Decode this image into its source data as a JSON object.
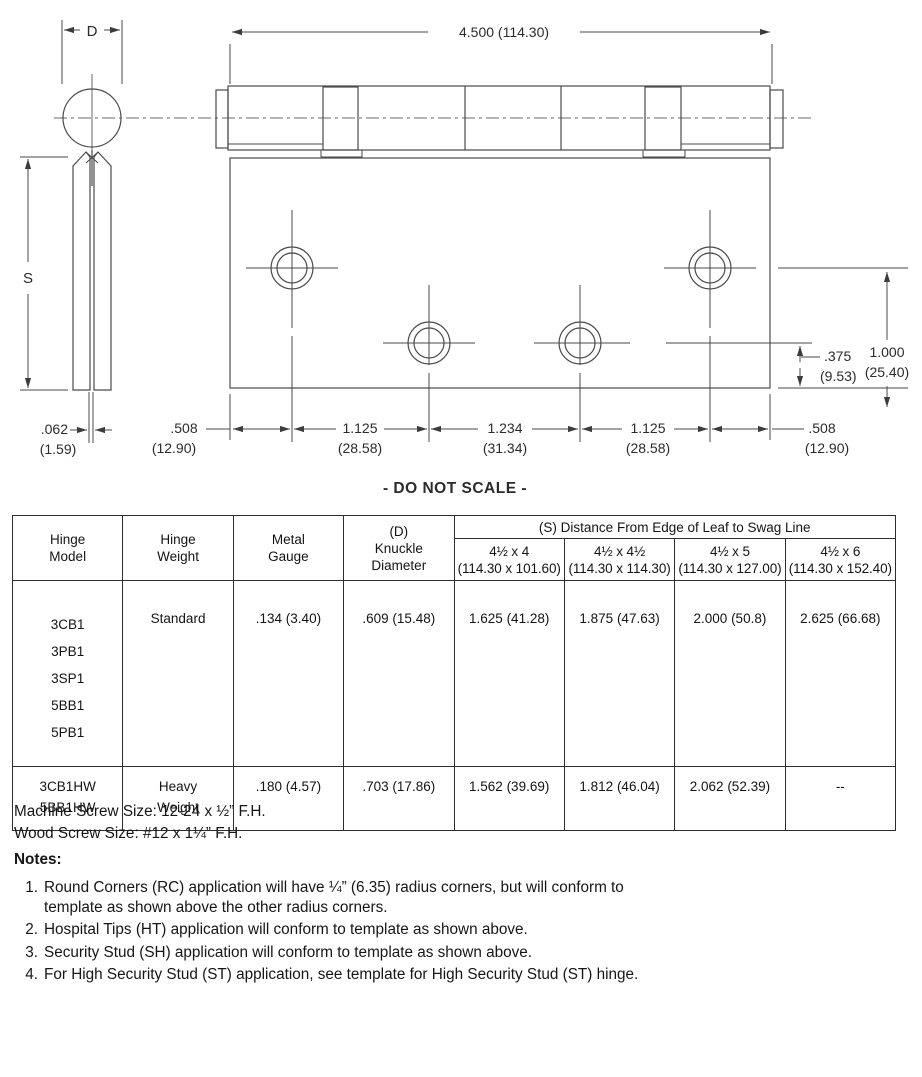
{
  "drawing": {
    "side": {
      "d": "D",
      "s": "S",
      "gap_in": ".062",
      "gap_mm": "(1.59)"
    },
    "front": {
      "overall": "4.500 (114.30)",
      "edge_left_in": ".508",
      "edge_left_mm": "(12.90)",
      "pitch1_in": "1.125",
      "pitch1_mm": "(28.58)",
      "pitch2_in": "1.234",
      "pitch2_mm": "(31.34)",
      "pitch3_in": "1.125",
      "pitch3_mm": "(28.58)",
      "edge_right_in": ".508",
      "edge_right_mm": "(12.90)",
      "hole_edge_in": ".375",
      "hole_edge_mm": "(9.53)",
      "row_edge_in": "1.000",
      "row_edge_mm": "(25.40)"
    },
    "do_not_scale": "- DO NOT SCALE -"
  },
  "table": {
    "headers": {
      "model": "Hinge\nModel",
      "weight": "Hinge\nWeight",
      "gauge": "Metal\nGauge",
      "knuckle": "(D)\nKnuckle\nDiameter",
      "s_group": "(S) Distance From Edge of Leaf to Swag Line",
      "sizes": [
        "4½ x 4\n(114.30 x 101.60)",
        "4½ x 4½\n(114.30 x 114.30)",
        "4½ x 5\n(114.30 x 127.00)",
        "4½ x 6\n(114.30 x 152.40)"
      ]
    },
    "rows": [
      {
        "models": "3CB1\n3PB1\n3SP1\n5BB1\n5PB1",
        "weight": "Standard",
        "gauge": ".134 (3.40)",
        "knuckle": ".609 (15.48)",
        "s1": "1.625 (41.28)",
        "s2": "1.875 (47.63)",
        "s3": "2.000 (50.8)",
        "s4": "2.625 (66.68)"
      },
      {
        "models": "3CB1HW\n5BB1HW",
        "weight": "Heavy\nWeight",
        "gauge": ".180 (4.57)",
        "knuckle": ".703 (17.86)",
        "s1": "1.562 (39.69)",
        "s2": "1.812 (46.04)",
        "s3": "2.062 (52.39)",
        "s4": "--"
      }
    ]
  },
  "screws": {
    "machine": "Machine Screw Size: 12-24 x ½” F.H.",
    "wood": "Wood Screw Size: #12 x 1¼” F.H."
  },
  "notes": {
    "title": "Notes:",
    "items": [
      {
        "num": "1.",
        "text": "Round Corners (RC) application will have ¼” (6.35) radius corners, but will conform to\ntemplate as shown above the other radius corners."
      },
      {
        "num": "2.",
        "text": "Hospital Tips (HT) application will conform to template as shown above."
      },
      {
        "num": "3.",
        "text": "Security Stud (SH) application will conform to template as shown above."
      },
      {
        "num": "4.",
        "text": "For High Security Stud (ST) application, see template for High Security Stud (ST) hinge."
      }
    ]
  }
}
